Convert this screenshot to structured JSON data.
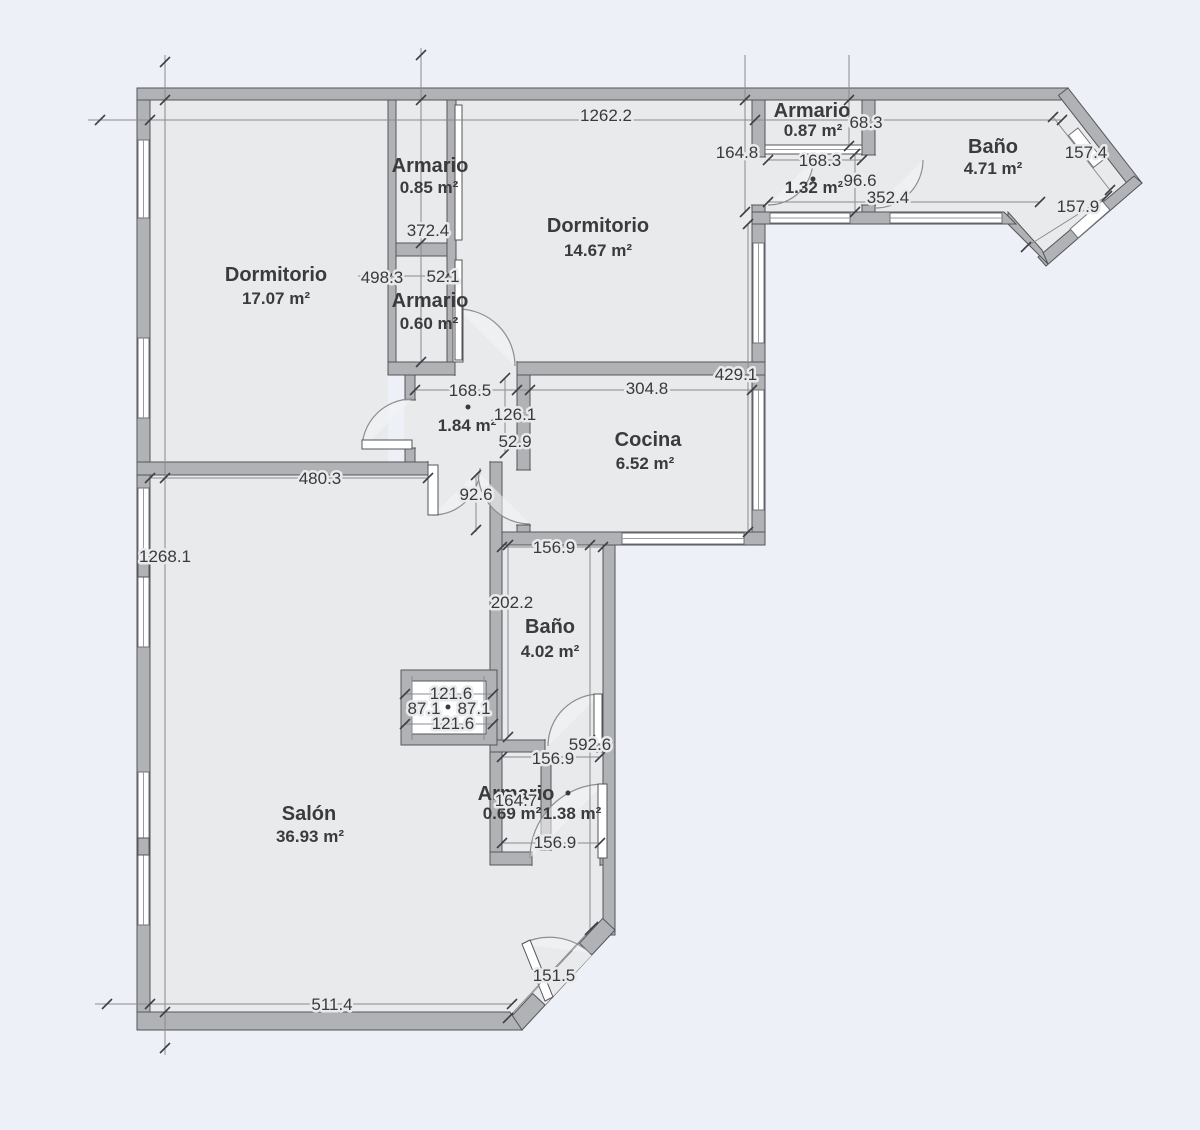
{
  "palette": {
    "background": "#edf0f7",
    "floor": "#e9eaeb",
    "wall": "#b1b2b5",
    "wall_outline": "#54555a",
    "dimension_line": "#8a8b90",
    "text": "#3b3b3e"
  },
  "rooms": {
    "dormitorio_izq": {
      "name": "Dormitorio",
      "area": "17.07 m²"
    },
    "armario_sup": {
      "name": "Armario",
      "area": "0.85 m²"
    },
    "armario_med": {
      "name": "Armario",
      "area": "0.60 m²"
    },
    "dormitorio_der": {
      "name": "Dormitorio",
      "area": "14.67 m²"
    },
    "armario_tr": {
      "name": "Armario",
      "area": "0.87 m²"
    },
    "distribuidor_tr": {
      "area": "1.32 m²"
    },
    "bano_tr": {
      "name": "Baño",
      "area": "4.71 m²"
    },
    "distribuidor": {
      "area": "1.84 m²"
    },
    "cocina": {
      "name": "Cocina",
      "area": "6.52 m²"
    },
    "bano_med": {
      "name": "Baño",
      "area": "4.02 m²"
    },
    "armario_inf": {
      "name": "Armario",
      "area": "0.69 m²"
    },
    "vestibulo_inf": {
      "area": "1.38 m²"
    },
    "salon": {
      "name": "Salón",
      "area": "36.93 m²"
    }
  },
  "dims": {
    "d1262_2": "1262.2",
    "d1268_1": "1268.1",
    "d164_8": "164.8",
    "d68_3": "68.3",
    "d168_3": "168.3",
    "d96_6": "96.6",
    "d352_4": "352.4",
    "d157_4": "157.4",
    "d157_9": "157.9",
    "d372_4": "372.4",
    "d498_3": "498.3",
    "d52_1": "52.1",
    "d168_5": "168.5",
    "d304_8": "304.8",
    "d429_1": "429.1",
    "d126_1": "126.1",
    "d52_9": "52.9",
    "d480_3": "480.3",
    "d92_6": "92.6",
    "d156_9a": "156.9",
    "d202_2": "202.2",
    "d121_6a": "121.6",
    "d87_1a": "87.1",
    "d87_1b": "87.1",
    "d121_6b": "121.6",
    "d592_6": "592.6",
    "d156_9b": "156.9",
    "d164_7": "164.7",
    "d156_9c": "156.9",
    "d151_5": "151.5",
    "d511_4": "511.4"
  }
}
